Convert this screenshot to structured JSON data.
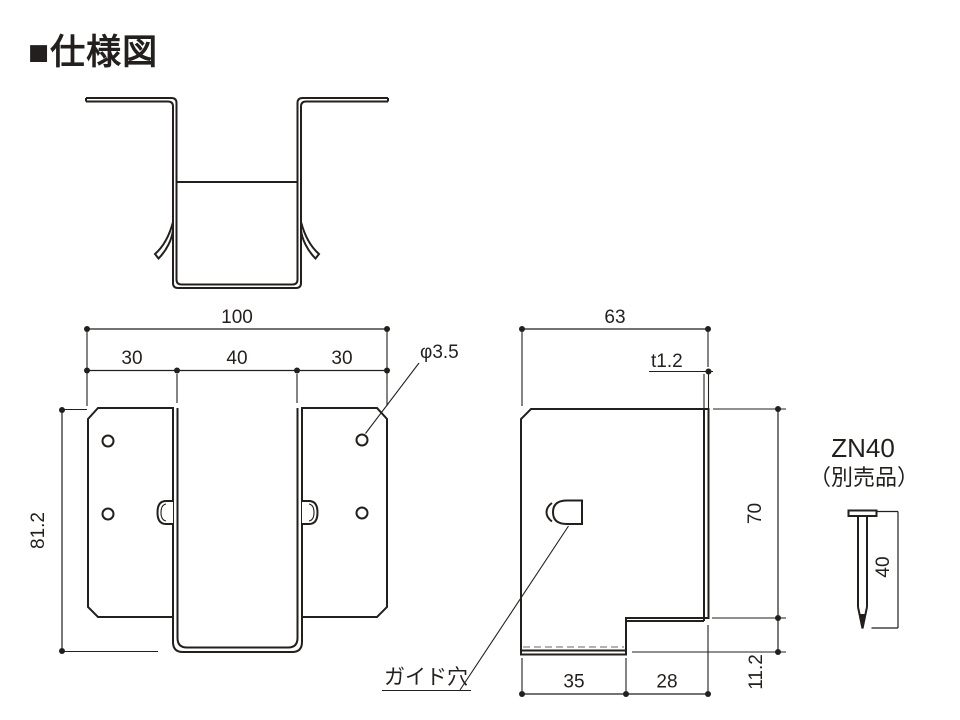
{
  "page": {
    "title": "■仕様図",
    "background": "#ffffff",
    "line_color": "#231f1d",
    "bend_dash_color": "#9a9a9a"
  },
  "front_view": {
    "overall_width": "100",
    "seg_left": "30",
    "seg_center": "40",
    "seg_right": "30",
    "height": "81.2",
    "hole_diameter": "φ3.5"
  },
  "side_view": {
    "width": "63",
    "thickness": "t1.2",
    "height": "70",
    "bottom_front": "35",
    "bottom_back": "28",
    "step_height": "11.2",
    "guide_hole_label": "ガイド穴"
  },
  "nail": {
    "model": "ZN40",
    "availability_note": "（別売品）",
    "length": "40"
  }
}
